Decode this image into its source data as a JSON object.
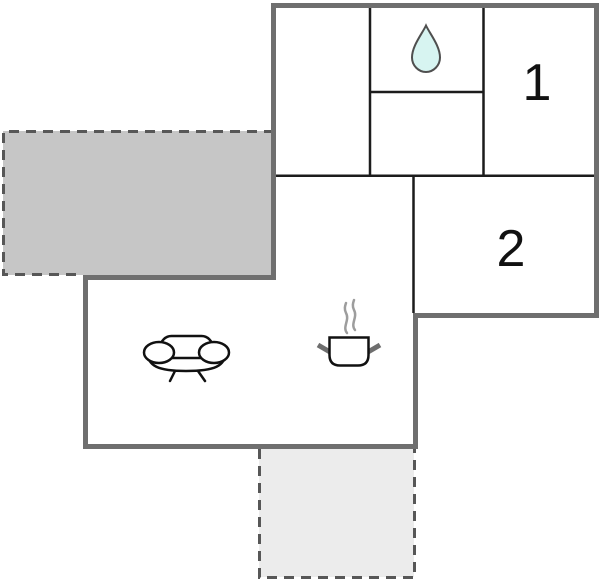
{
  "floorplan": {
    "type": "apartment-floor-plan",
    "rooms": [
      {
        "name": "bedroom-1",
        "label": "1"
      },
      {
        "name": "bedroom-2",
        "label": "2"
      },
      {
        "name": "bathroom",
        "label": "",
        "icon": "water-drop-icon"
      },
      {
        "name": "living-room",
        "label": "",
        "icon": "sofa-icon"
      },
      {
        "name": "kitchen",
        "label": "",
        "icon": "cooking-pot-icon"
      },
      {
        "name": "hallway",
        "label": ""
      }
    ],
    "terraces": [
      {
        "name": "terrace-side",
        "style": "shaded",
        "fill": "#c6c6c6"
      },
      {
        "name": "terrace-bottom",
        "style": "light",
        "fill": "#ececec"
      }
    ],
    "colors": {
      "outer_wall": "#6f6f6f",
      "interior_wall": "#1c1c1c",
      "terrace_side_fill": "#c6c6c6",
      "terrace_bottom_fill": "#ececec",
      "terrace_border": "#575757",
      "drop_fill": "#d7f4f1",
      "drop_stroke": "#4f4f4f",
      "icon_stroke": "#111111",
      "steam": "#9d9d9d",
      "pot_handle": "#6e6e6e",
      "label_color": "#111111",
      "background": "#ffffff"
    }
  }
}
